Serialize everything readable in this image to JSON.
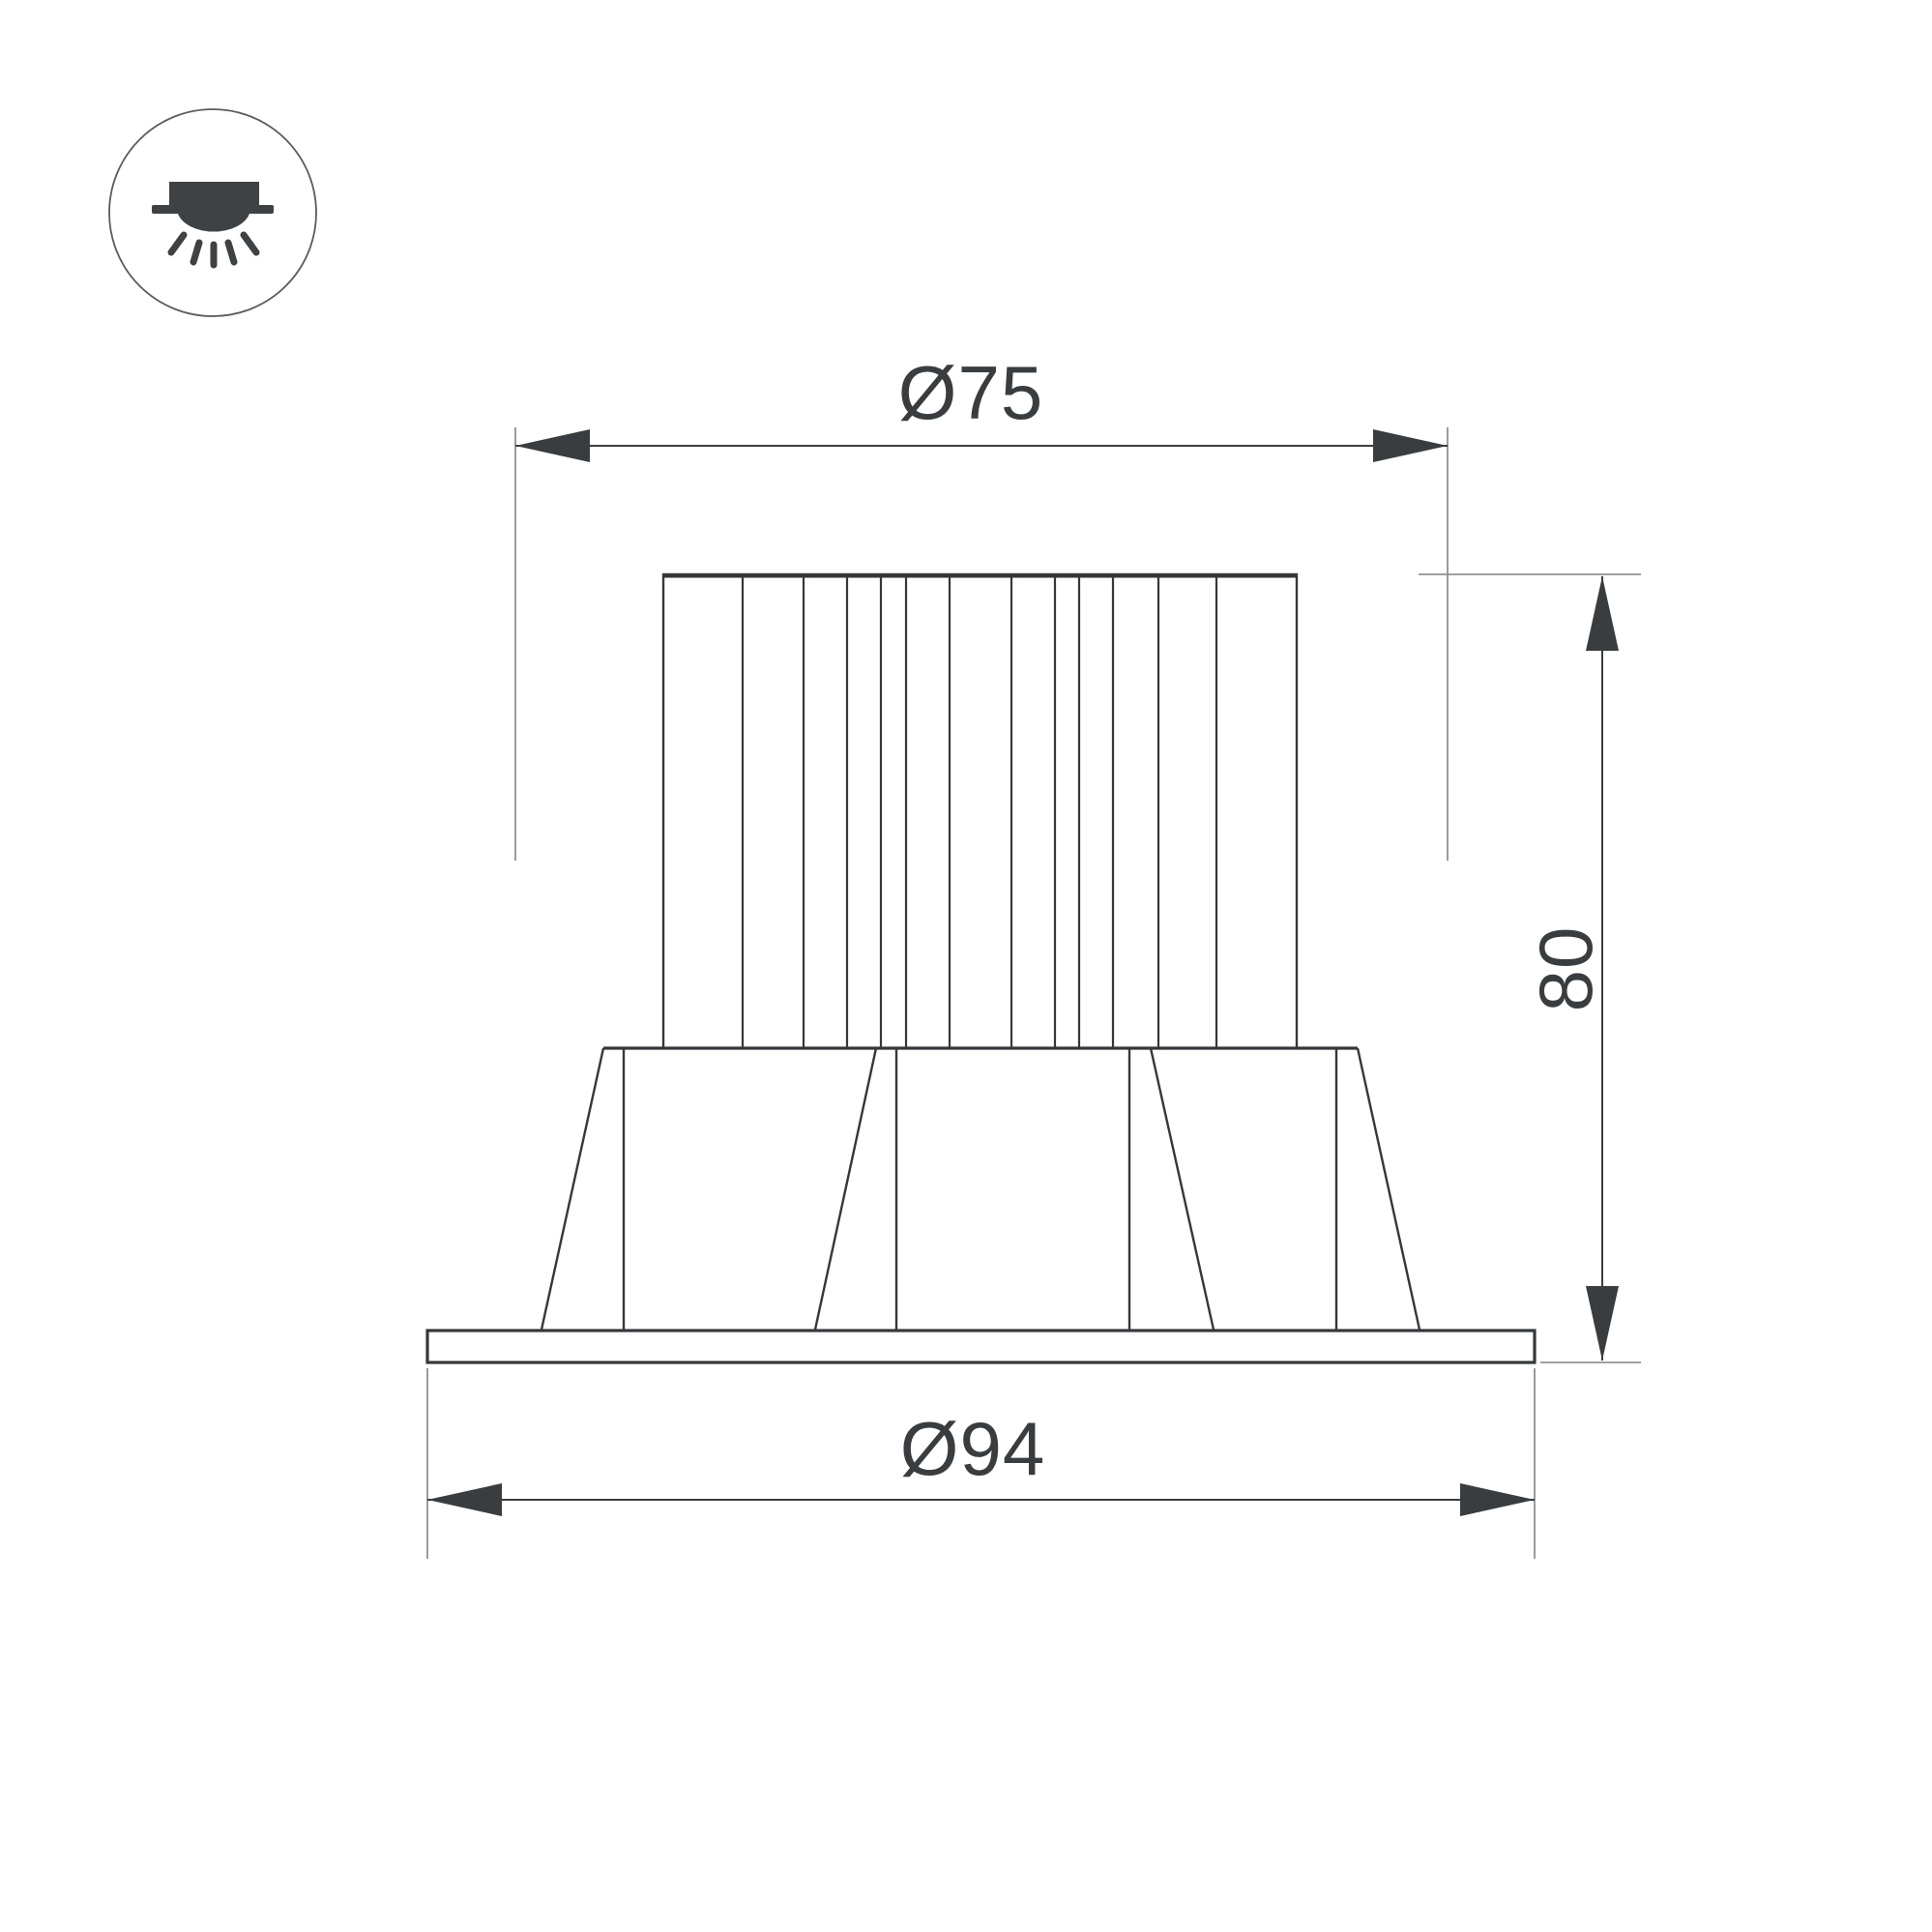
{
  "page": {
    "background": "#ffffff"
  },
  "colors": {
    "ink": "#3a3d40",
    "object_line": "#35383b",
    "extension_line": "#8f9294",
    "icon_fill": "#3f4245",
    "icon_ring": "#595c5f"
  },
  "icon": {
    "name": "recessed-downlight-icon"
  },
  "dimensions": {
    "top_diameter": {
      "label": "Ø75",
      "value": 75
    },
    "bottom_diameter": {
      "label": "Ø94",
      "value": 94
    },
    "height": {
      "label": "80",
      "value": 80
    }
  }
}
